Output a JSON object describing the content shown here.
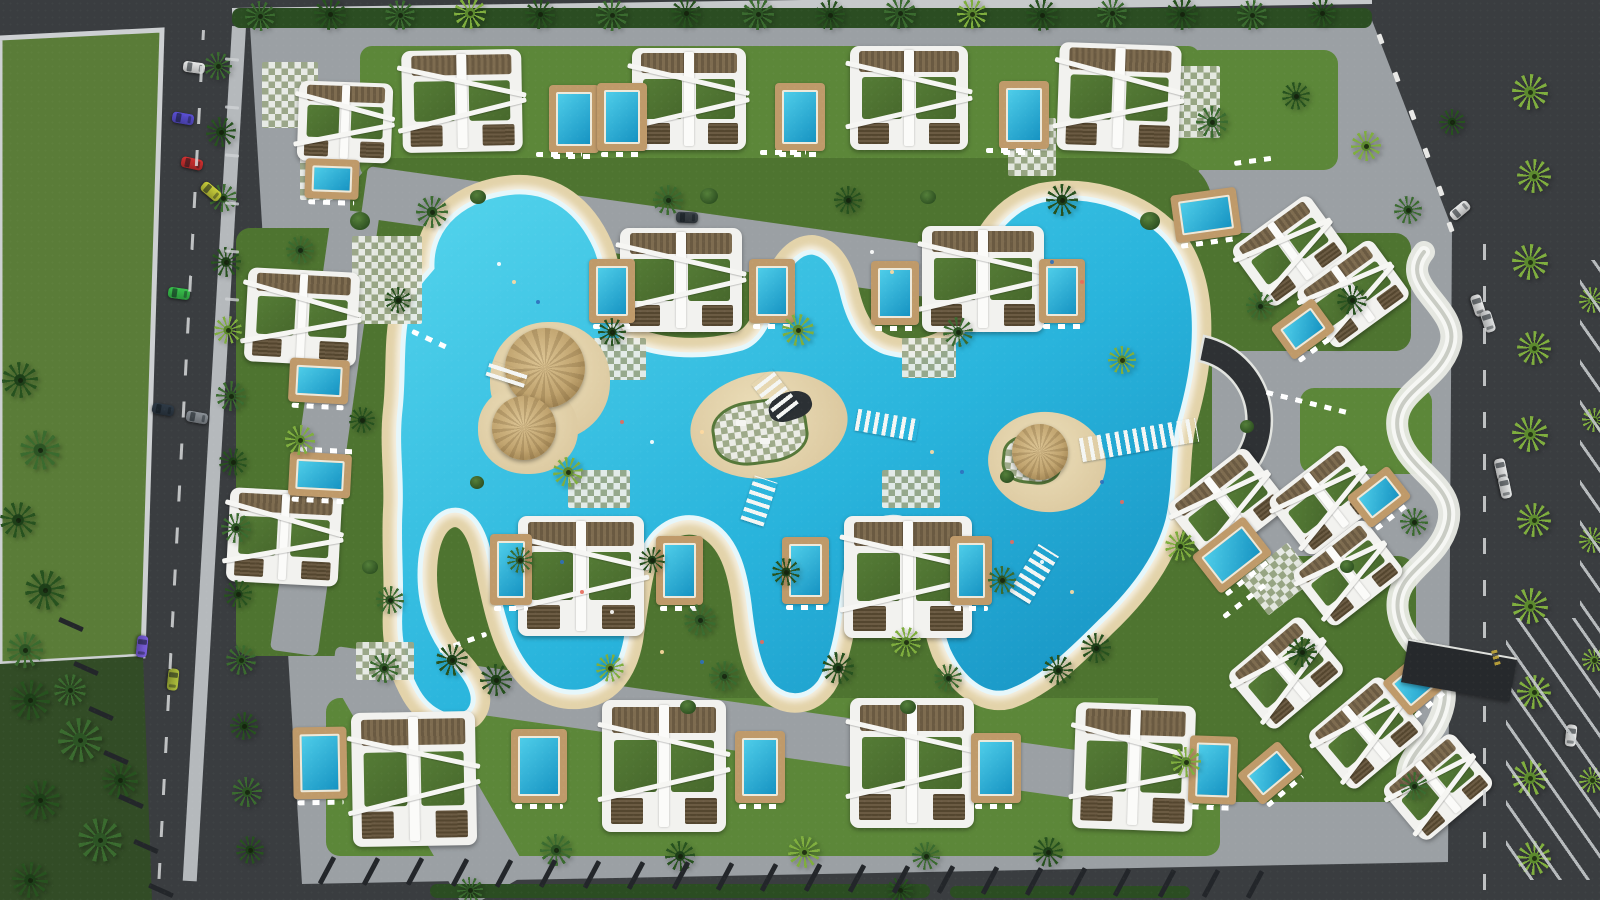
{
  "meta": {
    "title": "resort-masterplan-aerial-render",
    "canvas_w": 1600,
    "canvas_h": 900
  },
  "palette": {
    "asphalt": "#3a3d40",
    "asphalt_dark": "#2c2f32",
    "field_green": "#5a7c38",
    "forest_green": "#324c26",
    "lawn_green": "#4e7430",
    "lawn_light": "#5c8739",
    "paving_gray": "#9ba0a4",
    "paving_light": "#b8bcbe",
    "sand": "#e3d3aa",
    "water_light": "#54d4ec",
    "water_mid": "#29b4dc",
    "water_deep": "#158fc0",
    "foam_white": "#e6f7fb",
    "pool_teal": "#1693c2",
    "deck_tan": "#bf9a6a",
    "villa_white": "#f2f2ef",
    "wood_brown": "#6a5a42",
    "roof_garden_green": "#4f7434",
    "palm_dark": "#27521f",
    "palm_mid": "#3a6b2f",
    "palm_light": "#7fae3e",
    "wall_white": "#eff0ec",
    "fence_dark": "#23262a",
    "sidewalk": "#cdd0d2",
    "crescent_dark": "#2e3134",
    "speed_bump_yellow": "#d8b93c"
  },
  "shapes": {
    "field": "M0,38 L162,30 L143,656 L0,664 Z",
    "forest": "M0,664 L143,656 L152,900 L0,900 Z",
    "parcel": "M250,26 L1368,10 L1452,228 L1448,862 L302,884 Z",
    "lagoon": "M432,268 C430,225 465,196 515,192 C552,190 580,212 596,248 C606,272 608,310 622,338 C648,356 700,360 742,348 C766,340 772,310 782,282 C788,264 800,252 812,252 C826,254 836,268 842,292 C848,318 858,342 885,352 C912,360 940,355 958,338 C972,322 972,292 982,262 C992,232 1012,208 1042,200 C1085,192 1130,205 1160,232 C1180,250 1192,280 1194,315 C1196,352 1190,385 1180,420 C1172,450 1176,485 1168,520 C1158,558 1132,592 1100,622 C1072,650 1042,680 1008,692 C985,698 962,680 948,650 C938,625 936,590 930,558 C924,528 908,514 886,518 C862,522 850,545 845,578 C840,615 836,655 820,682 C808,698 790,700 775,688 C760,675 754,645 750,612 C746,575 738,540 712,524 C688,510 660,520 646,545 C636,565 632,600 626,640 C620,672 603,690 578,692 C552,694 530,678 515,648 C502,622 496,585 488,550 C480,518 464,505 446,512 C428,520 420,545 420,575 C420,610 432,640 452,662 C470,680 480,700 468,712 C452,722 430,712 418,692 C404,668 398,640 400,610 C402,580 398,545 400,510 C402,478 396,445 400,410 C404,375 400,340 408,308 C414,285 424,278 432,268 Z",
    "crescent": "M1204,336 A86,86 0 0 1 1215,501 L1207,476 A60,60 0 0 0 1199,361 Z",
    "wall": "M1424,252 C1396,286 1462,308 1450,346 C1438,384 1390,392 1398,432 C1406,472 1458,484 1448,524 C1438,564 1392,572 1398,612 C1404,652 1452,664 1444,704 C1436,744 1400,752 1408,788"
  },
  "lawns": [
    [
      360,
      46,
      840,
      132,
      12
    ],
    [
      350,
      158,
      862,
      566,
      46
    ],
    [
      326,
      698,
      894,
      158,
      14
    ],
    [
      236,
      228,
      148,
      428,
      14
    ],
    [
      1186,
      50,
      152,
      120,
      14
    ],
    [
      1203,
      233,
      208,
      118,
      16
    ],
    [
      1300,
      388,
      132,
      86,
      14
    ],
    [
      1158,
      556,
      258,
      246,
      18
    ]
  ],
  "path_rects": [
    [
      368,
      166,
      830,
      52,
      8
    ],
    [
      336,
      646,
      840,
      48,
      8
    ],
    [
      332,
      208,
      48,
      446,
      8
    ],
    [
      330,
      676,
      74,
      270,
      -30
    ]
  ],
  "tiles": [
    [
      352,
      236,
      70,
      88,
      0
    ],
    [
      588,
      338,
      58,
      42,
      0
    ],
    [
      902,
      338,
      54,
      40,
      0
    ],
    [
      568,
      470,
      62,
      38,
      0
    ],
    [
      882,
      470,
      58,
      38,
      0
    ],
    [
      356,
      642,
      58,
      38,
      0
    ],
    [
      1008,
      118,
      48,
      58,
      0
    ],
    [
      1158,
      66,
      62,
      72,
      0
    ],
    [
      1248,
      556,
      60,
      46,
      -38
    ],
    [
      262,
      62,
      56,
      66,
      0
    ],
    [
      300,
      150,
      40,
      50,
      0
    ]
  ],
  "villas": [
    [
      402,
      50,
      120,
      102,
      -1
    ],
    [
      632,
      48,
      114,
      102,
      0
    ],
    [
      850,
      46,
      118,
      104,
      0
    ],
    [
      1058,
      44,
      122,
      108,
      2
    ],
    [
      620,
      228,
      122,
      104,
      0
    ],
    [
      922,
      226,
      122,
      106,
      0
    ],
    [
      518,
      516,
      126,
      120,
      0
    ],
    [
      844,
      516,
      128,
      122,
      0
    ],
    [
      352,
      712,
      124,
      134,
      -1
    ],
    [
      602,
      700,
      124,
      132,
      0
    ],
    [
      850,
      698,
      124,
      130,
      0
    ],
    [
      1074,
      704,
      120,
      126,
      2
    ],
    [
      246,
      270,
      112,
      94,
      3
    ],
    [
      228,
      490,
      112,
      94,
      3
    ],
    [
      298,
      82,
      94,
      80,
      2
    ],
    [
      1242,
      214,
      96,
      74,
      -36
    ],
    [
      1306,
      258,
      94,
      72,
      -36
    ],
    [
      1178,
      468,
      100,
      76,
      -38
    ],
    [
      1278,
      464,
      96,
      72,
      -38
    ],
    [
      1302,
      538,
      92,
      70,
      -38
    ],
    [
      1238,
      636,
      96,
      74,
      -40
    ],
    [
      1318,
      696,
      96,
      74,
      -40
    ],
    [
      1392,
      752,
      92,
      70,
      -40
    ]
  ],
  "pools": [
    [
      556,
      92,
      36,
      54,
      0
    ],
    [
      604,
      90,
      36,
      54,
      0
    ],
    [
      782,
      90,
      36,
      54,
      0
    ],
    [
      1006,
      88,
      36,
      54,
      0
    ],
    [
      1180,
      198,
      52,
      34,
      -8
    ],
    [
      596,
      266,
      32,
      50,
      0
    ],
    [
      756,
      266,
      32,
      50,
      0
    ],
    [
      878,
      268,
      34,
      50,
      0
    ],
    [
      1046,
      266,
      32,
      50,
      0
    ],
    [
      497,
      541,
      28,
      57,
      0
    ],
    [
      663,
      543,
      33,
      55,
      0
    ],
    [
      789,
      544,
      33,
      53,
      0
    ],
    [
      957,
      543,
      28,
      55,
      0
    ],
    [
      300,
      734,
      40,
      58,
      -1
    ],
    [
      518,
      736,
      42,
      60,
      0
    ],
    [
      742,
      738,
      36,
      58,
      0
    ],
    [
      978,
      740,
      36,
      56,
      0
    ],
    [
      1196,
      743,
      34,
      54,
      2
    ],
    [
      296,
      366,
      46,
      30,
      3
    ],
    [
      296,
      460,
      48,
      30,
      3
    ],
    [
      312,
      166,
      40,
      26,
      2
    ],
    [
      1284,
      316,
      38,
      26,
      -36
    ],
    [
      1360,
      484,
      38,
      26,
      -38
    ],
    [
      1206,
      538,
      52,
      34,
      -38
    ],
    [
      1396,
      666,
      44,
      30,
      -40
    ],
    [
      1250,
      760,
      40,
      26,
      -40
    ]
  ],
  "islands": {
    "left": {
      "sand": [
        [
          490,
          322,
          120,
          118
        ],
        [
          478,
          384,
          100,
          90
        ]
      ],
      "thatch": [
        [
          505,
          328,
          80
        ],
        [
          492,
          396,
          64
        ]
      ]
    },
    "center": {
      "sand": [
        690,
        372,
        158,
        106,
        -8
      ],
      "checker": [
        712,
        400,
        96,
        64,
        -8
      ],
      "shade": [
        768,
        392,
        44,
        28,
        -18
      ],
      "furniture": [
        [
          736,
          420
        ],
        [
          760,
          438
        ]
      ]
    },
    "right": {
      "sand": [
        988,
        412,
        118,
        100,
        6
      ],
      "checker": [
        1002,
        436,
        60,
        48,
        6
      ],
      "thatch": [
        [
          1012,
          424,
          56
        ]
      ]
    }
  },
  "bridges": [
    [
      487,
      366,
      40,
      16,
      18,
      0
    ],
    [
      856,
      414,
      62,
      22,
      10,
      90
    ],
    [
      747,
      478,
      24,
      46,
      18,
      0
    ],
    [
      762,
      372,
      26,
      44,
      -38,
      0
    ],
    [
      1080,
      428,
      118,
      24,
      -10,
      90
    ],
    [
      1022,
      546,
      24,
      56,
      32,
      0
    ],
    [
      988,
      236,
      22,
      44,
      -20,
      0
    ]
  ],
  "palms": [
    [
      260,
      16,
      15,
      1
    ],
    [
      330,
      14,
      16,
      0
    ],
    [
      400,
      15,
      15,
      1
    ],
    [
      470,
      13,
      16,
      2
    ],
    [
      540,
      14,
      15,
      0
    ],
    [
      612,
      15,
      16,
      1
    ],
    [
      686,
      13,
      15,
      0
    ],
    [
      758,
      14,
      16,
      1
    ],
    [
      830,
      15,
      15,
      0
    ],
    [
      900,
      13,
      16,
      1
    ],
    [
      972,
      14,
      15,
      2
    ],
    [
      1042,
      15,
      16,
      0
    ],
    [
      1112,
      13,
      15,
      1
    ],
    [
      1182,
      14,
      16,
      0
    ],
    [
      1252,
      15,
      15,
      1
    ],
    [
      1322,
      13,
      14,
      0
    ],
    [
      218,
      66,
      14,
      1
    ],
    [
      221,
      132,
      15,
      0
    ],
    [
      223,
      198,
      14,
      1
    ],
    [
      226,
      262,
      15,
      0
    ],
    [
      228,
      330,
      14,
      2
    ],
    [
      231,
      396,
      15,
      1
    ],
    [
      233,
      462,
      14,
      0
    ],
    [
      236,
      528,
      15,
      1
    ],
    [
      238,
      594,
      14,
      0
    ],
    [
      241,
      660,
      15,
      1
    ],
    [
      244,
      726,
      14,
      0
    ],
    [
      247,
      792,
      15,
      1
    ],
    [
      250,
      850,
      14,
      0
    ],
    [
      432,
      212,
      16,
      1
    ],
    [
      398,
      300,
      13,
      0
    ],
    [
      300,
      250,
      14,
      1
    ],
    [
      362,
      420,
      13,
      0
    ],
    [
      300,
      440,
      15,
      2
    ],
    [
      390,
      600,
      14,
      1
    ],
    [
      452,
      660,
      16,
      0
    ],
    [
      568,
      472,
      15,
      2
    ],
    [
      612,
      332,
      14,
      0
    ],
    [
      668,
      200,
      15,
      1
    ],
    [
      798,
      330,
      16,
      2
    ],
    [
      848,
      200,
      14,
      0
    ],
    [
      958,
      332,
      15,
      1
    ],
    [
      1062,
      200,
      16,
      0
    ],
    [
      1122,
      360,
      14,
      2
    ],
    [
      700,
      620,
      16,
      1
    ],
    [
      786,
      572,
      14,
      0
    ],
    [
      906,
      642,
      15,
      2
    ],
    [
      1002,
      580,
      14,
      1
    ],
    [
      1096,
      648,
      15,
      0
    ],
    [
      520,
      560,
      13,
      1
    ],
    [
      652,
      560,
      13,
      0
    ],
    [
      384,
      668,
      15,
      1
    ],
    [
      496,
      680,
      16,
      0
    ],
    [
      610,
      668,
      14,
      2
    ],
    [
      724,
      676,
      15,
      1
    ],
    [
      838,
      668,
      16,
      0
    ],
    [
      948,
      678,
      14,
      1
    ],
    [
      1058,
      670,
      15,
      0
    ],
    [
      556,
      850,
      16,
      1
    ],
    [
      680,
      856,
      15,
      0
    ],
    [
      804,
      852,
      16,
      2
    ],
    [
      926,
      856,
      14,
      1
    ],
    [
      1048,
      852,
      15,
      0
    ],
    [
      470,
      890,
      13,
      1
    ],
    [
      900,
      890,
      13,
      0
    ],
    [
      1212,
      122,
      16,
      1
    ],
    [
      1296,
      96,
      14,
      0
    ],
    [
      1366,
      146,
      15,
      2
    ],
    [
      1260,
      306,
      14,
      1
    ],
    [
      1352,
      300,
      15,
      0
    ],
    [
      1180,
      546,
      15,
      2
    ],
    [
      1414,
      522,
      14,
      1
    ],
    [
      1302,
      652,
      15,
      0
    ],
    [
      1414,
      786,
      14,
      1
    ],
    [
      1186,
      762,
      15,
      2
    ],
    [
      1452,
      122,
      13,
      0
    ],
    [
      1408,
      210,
      14,
      1
    ],
    [
      1530,
      92,
      18,
      2
    ],
    [
      1534,
      176,
      17,
      2
    ],
    [
      1530,
      262,
      18,
      2
    ],
    [
      1534,
      348,
      17,
      2
    ],
    [
      1530,
      434,
      18,
      2
    ],
    [
      1534,
      520,
      17,
      2
    ],
    [
      1530,
      606,
      18,
      2
    ],
    [
      1534,
      692,
      17,
      2
    ],
    [
      1530,
      778,
      18,
      2
    ],
    [
      1534,
      858,
      17,
      2
    ],
    [
      1592,
      300,
      13,
      2
    ],
    [
      1594,
      420,
      12,
      2
    ],
    [
      1592,
      540,
      13,
      2
    ],
    [
      1594,
      660,
      12,
      2
    ],
    [
      1592,
      780,
      13,
      2
    ],
    [
      30,
      700,
      20,
      0
    ],
    [
      80,
      740,
      22,
      1
    ],
    [
      40,
      800,
      20,
      0
    ],
    [
      100,
      840,
      22,
      1
    ],
    [
      30,
      880,
      18,
      0
    ],
    [
      120,
      780,
      18,
      0
    ],
    [
      70,
      690,
      16,
      1
    ],
    [
      20,
      380,
      18,
      0
    ],
    [
      40,
      450,
      20,
      1
    ],
    [
      18,
      520,
      18,
      0
    ],
    [
      45,
      590,
      20,
      0
    ],
    [
      25,
      650,
      18,
      1
    ]
  ],
  "bushes": [
    [
      350,
      212,
      20
    ],
    [
      470,
      190,
      16
    ],
    [
      700,
      188,
      18
    ],
    [
      920,
      190,
      16
    ],
    [
      1140,
      212,
      20
    ],
    [
      362,
      560,
      16
    ],
    [
      470,
      476,
      14
    ],
    [
      1000,
      470,
      14
    ],
    [
      680,
      700,
      16
    ],
    [
      900,
      700,
      16
    ],
    [
      1240,
      420,
      14
    ],
    [
      1340,
      560,
      14
    ]
  ],
  "cars": [
    [
      "#e9eaea",
      183,
      62,
      8
    ],
    [
      "#5a4fd4",
      172,
      113,
      10
    ],
    [
      "#d23030",
      181,
      158,
      12
    ],
    [
      "#c9cf3a",
      200,
      186,
      40
    ],
    [
      "#38c24c",
      168,
      288,
      8
    ],
    [
      "#2e3a46",
      152,
      404,
      10
    ],
    [
      "#8a9096",
      186,
      412,
      10
    ],
    [
      "#7b5fe0",
      131,
      641,
      96
    ],
    [
      "#aebf3c",
      162,
      674,
      96
    ],
    [
      "#e9eaea",
      1449,
      205,
      -40
    ],
    [
      "#e9eaea",
      1467,
      300,
      72
    ],
    [
      "#dfe1e2",
      1477,
      316,
      72
    ],
    [
      "#e9eaea",
      1490,
      464,
      78
    ],
    [
      "#e6e8e8",
      1494,
      482,
      78
    ],
    [
      "#e9eaea",
      1560,
      730,
      96
    ],
    [
      "#3a4248",
      676,
      212,
      2
    ]
  ],
  "loungers": [
    [
      536,
      152,
      46,
      0
    ],
    [
      760,
      150,
      46,
      0
    ],
    [
      986,
      148,
      46,
      0
    ],
    [
      1265,
      400,
      84,
      14
    ],
    [
      300,
      448,
      56,
      3
    ],
    [
      438,
      640,
      50,
      -20
    ],
    [
      1218,
      598,
      54,
      -38
    ],
    [
      410,
      338,
      44,
      25
    ],
    [
      1234,
      158,
      44,
      -8
    ]
  ],
  "people": [
    [
      497,
      262
    ],
    [
      512,
      280
    ],
    [
      536,
      300
    ],
    [
      620,
      420
    ],
    [
      650,
      440
    ],
    [
      700,
      430
    ],
    [
      560,
      560
    ],
    [
      580,
      590
    ],
    [
      610,
      610
    ],
    [
      660,
      650
    ],
    [
      700,
      660
    ],
    [
      760,
      640
    ],
    [
      900,
      430
    ],
    [
      930,
      450
    ],
    [
      960,
      470
    ],
    [
      1010,
      540
    ],
    [
      1040,
      560
    ],
    [
      1070,
      590
    ],
    [
      1100,
      480
    ],
    [
      1120,
      500
    ],
    [
      870,
      250
    ],
    [
      890,
      270
    ],
    [
      1050,
      260
    ],
    [
      1080,
      280
    ]
  ],
  "fence_rows": [
    {
      "x0": 312,
      "y0": 868,
      "x1": 1240,
      "y1": 882,
      "count": 22,
      "w": 30,
      "h": 5,
      "rot": -62
    },
    {
      "x0": 58,
      "y0": 622,
      "x1": 148,
      "y1": 888,
      "count": 7,
      "w": 26,
      "h": 5,
      "rot": 24
    }
  ],
  "posts": [
    [
      1378,
      34
    ],
    [
      1394,
      72
    ],
    [
      1410,
      110
    ],
    [
      1424,
      148
    ],
    [
      1438,
      186
    ],
    [
      1448,
      222
    ]
  ],
  "road_markings": {
    "dashes": [
      [
        202,
        30,
        850,
        3
      ],
      [
        1483,
        230,
        660,
        0
      ]
    ],
    "stalls": {
      "x": 225,
      "y": 58,
      "count": 6,
      "step": 48,
      "w": 14,
      "rot": 5
    }
  },
  "parking_zones": [
    {
      "x": 1506,
      "y": 618,
      "w": 94,
      "h": 262,
      "angle": 55
    },
    {
      "x": 1580,
      "y": 260,
      "w": 20,
      "h": 380,
      "angle": 55
    }
  ],
  "hedges": [
    [
      430,
      884,
      500,
      14
    ],
    [
      950,
      886,
      240,
      12
    ],
    [
      232,
      8,
      1140,
      20
    ]
  ],
  "strips": {
    "wall_top": [
      232,
      0,
      1140,
      12,
      -0.8
    ],
    "sidewalk_left": [
      232,
      26,
      14,
      856,
      3.3
    ]
  },
  "canopy": {
    "x": 1404,
    "y": 648,
    "w": 110,
    "h": 44,
    "rot": 10
  },
  "speed_bump": {
    "x": 1488,
    "y": 655,
    "w": 16,
    "h": 6,
    "rot": 75
  }
}
